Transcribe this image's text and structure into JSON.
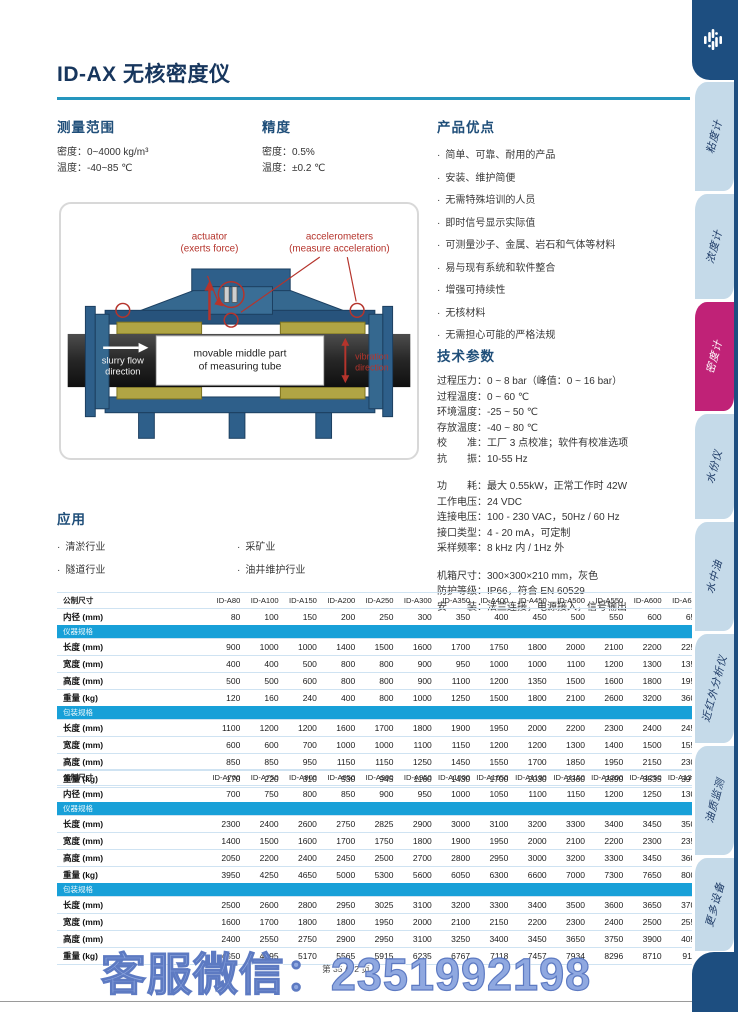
{
  "page": {
    "title": "ID-AX 无核密度仪",
    "footer": "第 35 / 72 页",
    "watermark": "客服微信：2351992198"
  },
  "colors": {
    "accent_line": "#2596be",
    "heading": "#1f4e79",
    "table_band": "#18a0d8",
    "sidebar_active": "#c02277",
    "sidebar_inactive": "#c5dae9",
    "sidebar_frame": "#1d4e80",
    "watermark": "#8fa8e0",
    "diagram_red": "#b5342c"
  },
  "sections": {
    "range": {
      "title": "测量范围",
      "items": [
        "密度：0~4000 kg/m³",
        "温度：-40~85 ℃"
      ]
    },
    "precision": {
      "title": "精度",
      "items": [
        "密度：0.5%",
        "温度：±0.2 ℃"
      ]
    },
    "advantages": {
      "title": "产品优点",
      "items": [
        "简单、可靠、耐用的产品",
        "安装、维护简便",
        "无需特殊培训的人员",
        "即时信号显示实际值",
        "可测量沙子、金属、岩石和气体等材料",
        "易与现有系统和软件整合",
        "增强可持续性",
        "无核材料",
        "无需担心可能的严格法规"
      ]
    },
    "tech": {
      "title": "技术参数",
      "groups": [
        [
          "过程压力：0 ~ 8 bar（峰值：0 ~ 16 bar）",
          "过程温度：0 ~ 60 ℃",
          "环境温度：-25 ~ 50 ℃",
          "存放温度：-40 ~ 80 ℃",
          "校　　准：工厂 3 点校准；软件有校准选项",
          "抗　　振：10-55 Hz"
        ],
        [
          "功　　耗：最大 0.55kW，正常工作时 42W",
          "工作电压：24 VDC",
          "连接电压：100 - 230 VAC，50Hz / 60 Hz",
          "接口类型：4 - 20 mA，可定制",
          "采样频率：8 kHz 内 / 1Hz 外"
        ],
        [
          "机箱尺寸：300×300×210 mm，灰色",
          "防护等级：IP66，符合 EN 60529",
          "安　　装：法兰连接，电源接入，信号输出"
        ]
      ]
    },
    "applications": {
      "title": "应用",
      "col1": [
        "清淤行业",
        "隧道行业"
      ],
      "col2": [
        "采矿业",
        "油井维护行业"
      ]
    }
  },
  "diagram": {
    "actuator_line1": "actuator",
    "actuator_line2": "(exerts force)",
    "accel_line1": "accelerometers",
    "accel_line2": "(measure acceleration)",
    "slurry_line1": "slurry flow",
    "slurry_line2": "direction",
    "middle_line1": "movable middle part",
    "middle_line2": "of measuring tube",
    "vibration_line1": "vibration",
    "vibration_line2": "direction"
  },
  "tables": [
    {
      "head_label": "公制尺寸",
      "models": [
        "ID-A80",
        "ID-A100",
        "ID-A150",
        "ID-A200",
        "ID-A250",
        "ID-A300",
        "ID-A350",
        "ID-A400",
        "ID-A450",
        "ID-A500",
        "ID-A550",
        "ID-A600",
        "ID-A650"
      ],
      "inner_row": {
        "label": "内径 (mm)",
        "values": [
          80,
          100,
          150,
          200,
          250,
          300,
          350,
          400,
          450,
          500,
          550,
          600,
          650
        ]
      },
      "groups": [
        {
          "band": "仪器规格",
          "rows": [
            {
              "label": "长度 (mm)",
              "values": [
                900,
                1000,
                1000,
                1400,
                1500,
                1600,
                1700,
                1750,
                1800,
                2000,
                2100,
                2200,
                2250
              ]
            },
            {
              "label": "宽度 (mm)",
              "values": [
                400,
                400,
                500,
                800,
                800,
                900,
                950,
                1000,
                1000,
                1100,
                1200,
                1300,
                1350
              ]
            },
            {
              "label": "高度 (mm)",
              "values": [
                500,
                500,
                600,
                800,
                800,
                900,
                1100,
                1200,
                1350,
                1500,
                1600,
                1800,
                1950
              ]
            },
            {
              "label": "重量 (kg)",
              "values": [
                120,
                160,
                240,
                400,
                800,
                1000,
                1250,
                1500,
                1800,
                2100,
                2600,
                3200,
                3600
              ]
            }
          ]
        },
        {
          "band": "包装规格",
          "rows": [
            {
              "label": "长度 (mm)",
              "values": [
                1100,
                1200,
                1200,
                1600,
                1700,
                1800,
                1900,
                1950,
                2000,
                2200,
                2300,
                2400,
                2450
              ]
            },
            {
              "label": "宽度 (mm)",
              "values": [
                600,
                600,
                700,
                1000,
                1000,
                1100,
                1150,
                1200,
                1200,
                1300,
                1400,
                1500,
                1550
              ]
            },
            {
              "label": "高度 (mm)",
              "values": [
                850,
                850,
                950,
                1150,
                1150,
                1250,
                1450,
                1550,
                1700,
                1850,
                1950,
                2150,
                2300
              ]
            },
            {
              "label": "重量 (kg)",
              "values": [
                170,
                220,
                310,
                530,
                945,
                1160,
                1430,
                1700,
                2030,
                2360,
                2890,
                3535,
                3970
              ]
            }
          ]
        }
      ]
    },
    {
      "head_label": "公制尺寸",
      "models": [
        "ID-A700",
        "ID-A750",
        "ID-A800",
        "ID-A850",
        "ID-A900",
        "ID-A950",
        "ID-A1000",
        "ID-A1050",
        "ID-A1100",
        "ID-A1150",
        "ID-A1200",
        "ID-A1250",
        "ID-A1300"
      ],
      "inner_row": {
        "label": "内径 (mm)",
        "values": [
          700,
          750,
          800,
          850,
          900,
          950,
          1000,
          1050,
          1100,
          1150,
          1200,
          1250,
          1300
        ]
      },
      "groups": [
        {
          "band": "仪器规格",
          "rows": [
            {
              "label": "长度 (mm)",
              "values": [
                2300,
                2400,
                2600,
                2750,
                2825,
                2900,
                3000,
                3100,
                3200,
                3300,
                3400,
                3450,
                3500
              ]
            },
            {
              "label": "宽度 (mm)",
              "values": [
                1400,
                1500,
                1600,
                1700,
                1750,
                1800,
                1900,
                1950,
                2000,
                2100,
                2200,
                2300,
                2350
              ]
            },
            {
              "label": "高度 (mm)",
              "values": [
                2050,
                2200,
                2400,
                2450,
                2500,
                2700,
                2800,
                2950,
                3000,
                3200,
                3300,
                3450,
                3600
              ]
            },
            {
              "label": "重量 (kg)",
              "values": [
                3950,
                4250,
                4650,
                5000,
                5300,
                5600,
                6050,
                6300,
                6600,
                7000,
                7300,
                7650,
                8000
              ]
            }
          ]
        },
        {
          "band": "包装规格",
          "rows": [
            {
              "label": "长度 (mm)",
              "values": [
                2500,
                2600,
                2800,
                2950,
                3025,
                3100,
                3200,
                3300,
                3400,
                3500,
                3600,
                3650,
                3700
              ]
            },
            {
              "label": "宽度 (mm)",
              "values": [
                1600,
                1700,
                1800,
                1800,
                1950,
                2000,
                2100,
                2150,
                2200,
                2300,
                2400,
                2500,
                2550
              ]
            },
            {
              "label": "高度 (mm)",
              "values": [
                2400,
                2550,
                2750,
                2900,
                2950,
                3100,
                3250,
                3400,
                3450,
                3650,
                3750,
                3900,
                4050
              ]
            },
            {
              "label": "重量 (kg)",
              "values": [
                4350,
                4695,
                5170,
                5565,
                5915,
                6235,
                6767,
                7118,
                7457,
                7934,
                8296,
                8710,
                9111
              ]
            }
          ]
        }
      ]
    }
  ],
  "sidebar": {
    "tabs": [
      {
        "label": "粘度计",
        "active": false,
        "height": 112
      },
      {
        "label": "浓度计",
        "active": false,
        "height": 108
      },
      {
        "label": "密度计",
        "active": true,
        "height": 112
      },
      {
        "label": "水份仪",
        "active": false,
        "height": 108
      },
      {
        "label": "水中油",
        "active": false,
        "height": 112
      },
      {
        "label": "近红外分析仪",
        "active": false,
        "height": 112
      },
      {
        "label": "油质监测",
        "active": false,
        "height": 112
      },
      {
        "label": "更多设备",
        "active": false,
        "height": 96
      }
    ]
  }
}
